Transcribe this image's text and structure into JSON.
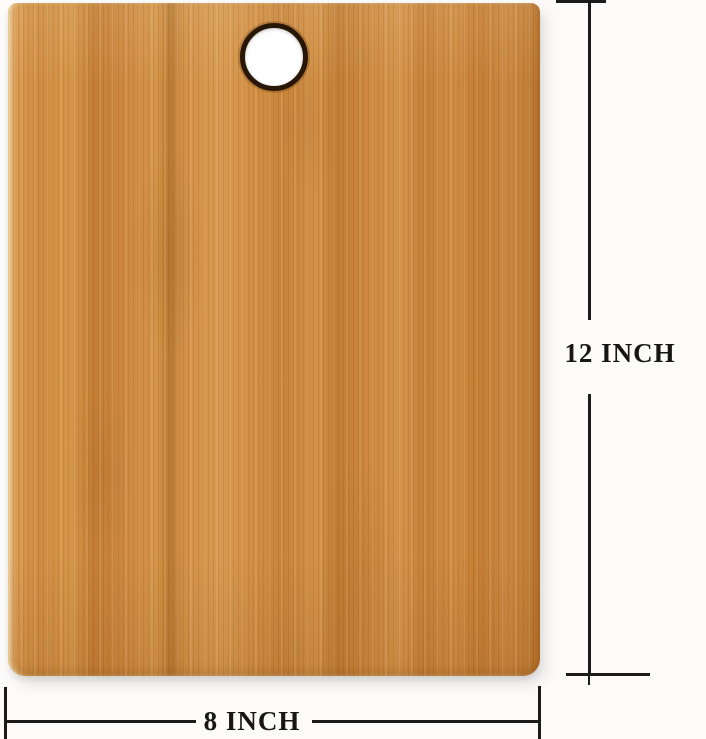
{
  "annotations": {
    "height": {
      "label": "12 INCH"
    },
    "width": {
      "label": "8 INCH"
    }
  },
  "colors": {
    "background": "#fcfbf9",
    "dimension_line": "#1b1b1b",
    "label_text": "#161616",
    "wood_base": "#cd8c44",
    "wood_dark": "#b97a32",
    "wood_light": "#dda05c",
    "hole_ring": "#281607",
    "hole_fill": "#ffffff"
  }
}
